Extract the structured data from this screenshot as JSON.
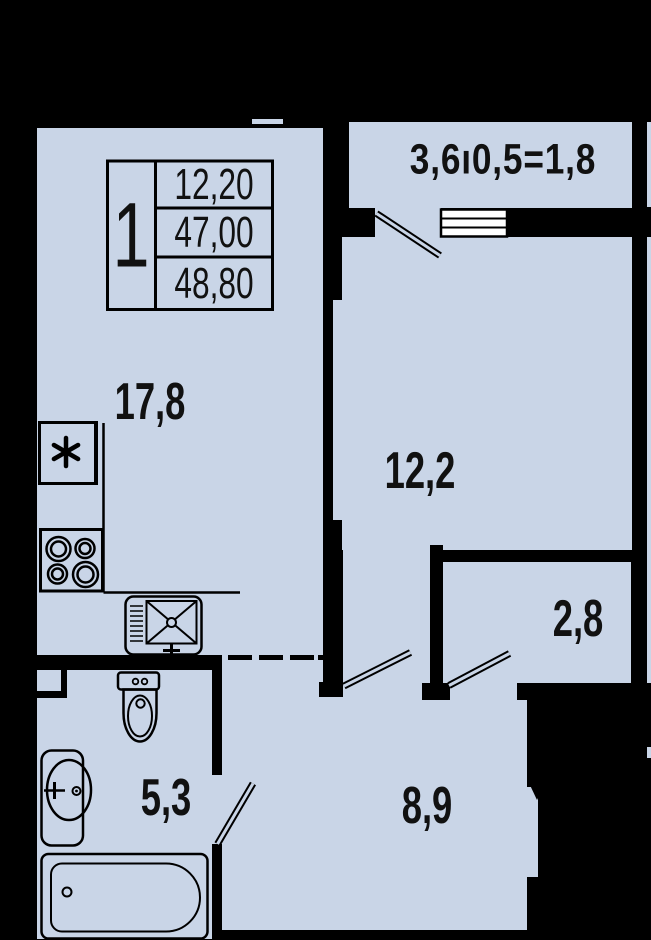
{
  "plan": {
    "title": "apartment-floor-plan",
    "unit_table": {
      "rooms_count": "1",
      "living_area": "12,20",
      "area_no_balcony": "47,00",
      "total_area": "48,80"
    },
    "rooms": {
      "living_kitchen": "17,8",
      "bedroom": "12,2",
      "closet": "2,8",
      "bathroom": "5,3",
      "hallway": "8,9"
    },
    "balcony_formula": "3,6ı0,5=1,8",
    "colors": {
      "floor": "#c9d5e7",
      "wall": "#000000",
      "window": "#ffffff"
    },
    "fixtures": [
      "fridge-icon",
      "stove-icon",
      "kitchen-sink-icon",
      "toilet-icon",
      "washbasin-icon",
      "bathtub-icon",
      "window-icon",
      "door-leaf-icon"
    ]
  }
}
